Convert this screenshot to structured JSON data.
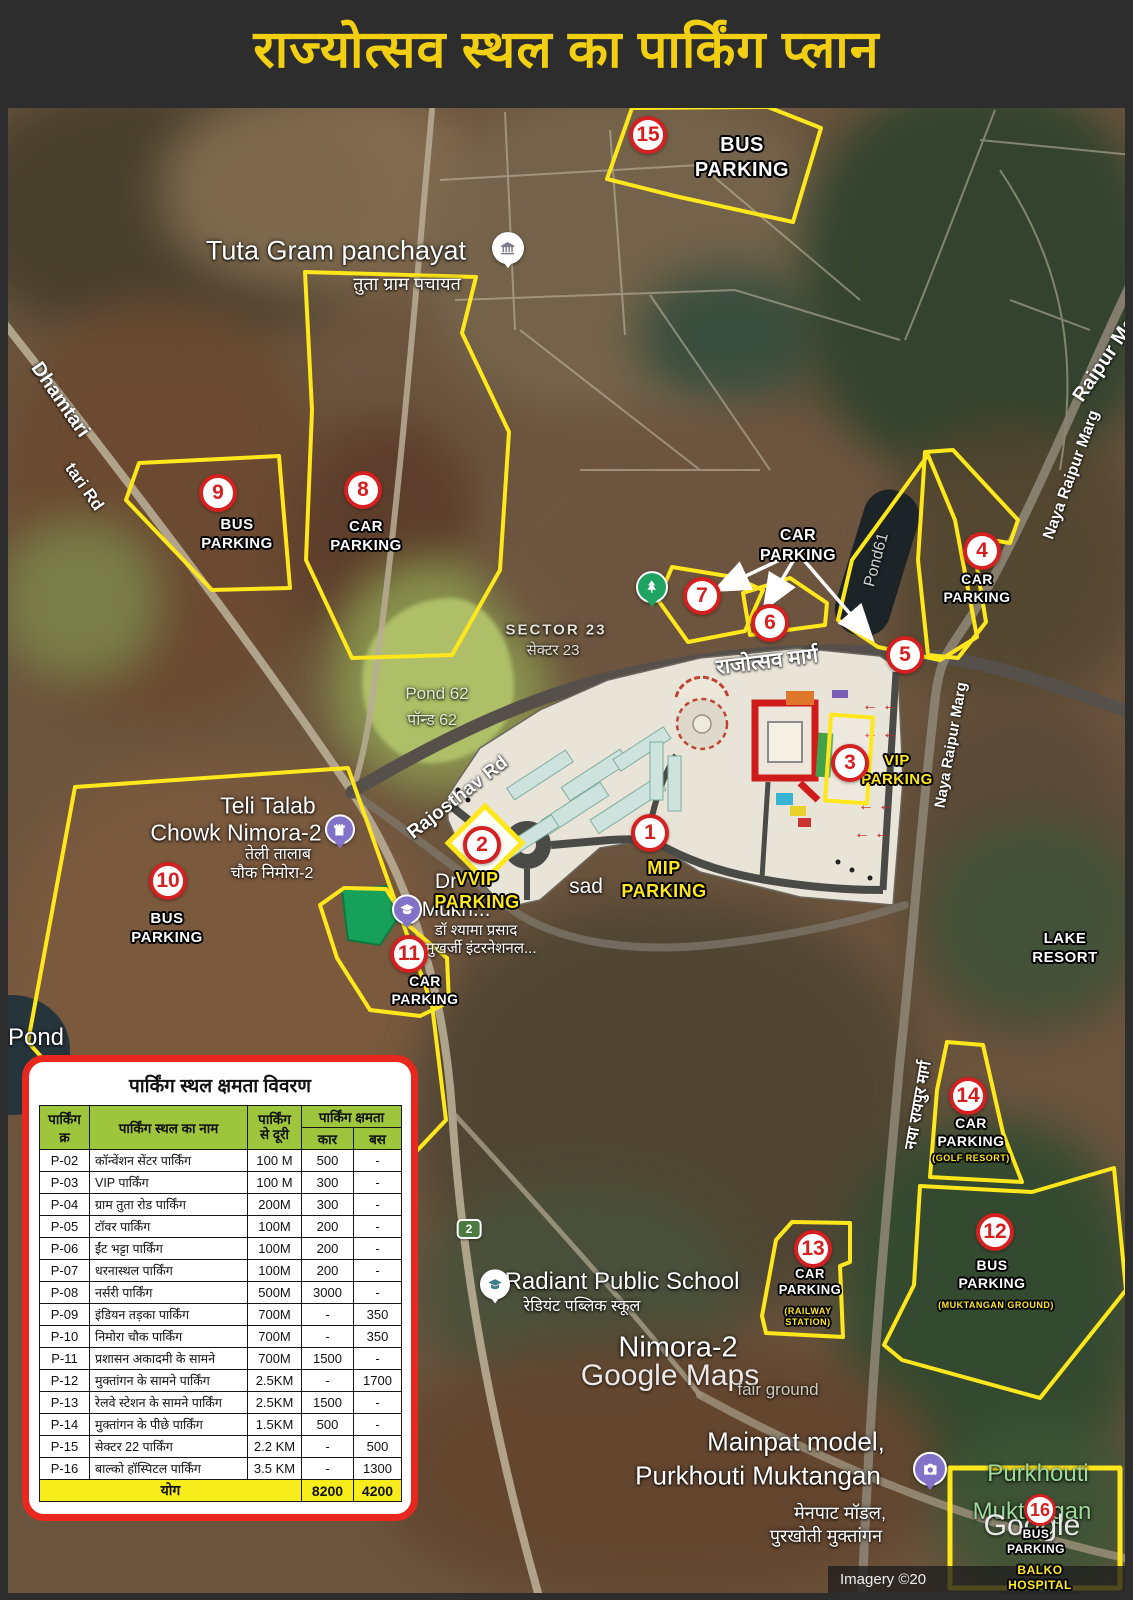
{
  "title": "राज्योत्सव स्थल का पार्किंग प्लान",
  "colors": {
    "accent_yellow": "#ffe71c",
    "marker_red": "#d42020",
    "title_yellow": "#f3cf11",
    "table_header_green": "#9dc63d",
    "table_total_yellow": "#f6ed1a",
    "table_border_red": "#e8281e"
  },
  "map": {
    "markers": [
      {
        "num": "1",
        "label": "MIP\nPARKING"
      },
      {
        "num": "2",
        "label": "VVIP\nPARKING"
      },
      {
        "num": "3",
        "label": "VIP\nPARKING"
      },
      {
        "num": "4",
        "label": "CAR\nPARKING"
      },
      {
        "num": "5"
      },
      {
        "num": "6"
      },
      {
        "num": "7"
      },
      {
        "num": "8",
        "label": "CAR\nPARKING"
      },
      {
        "num": "9",
        "label": "BUS\nPARKING"
      },
      {
        "num": "10",
        "label": "BUS\nPARKING"
      },
      {
        "num": "11",
        "label": "CAR\nPARKING"
      },
      {
        "num": "12",
        "label": "BUS\nPARKING",
        "sub": "(MUKTANGAN GROUND)"
      },
      {
        "num": "13",
        "label": "CAR\nPARKING",
        "sub": "(RAILWAY\nSTATION)"
      },
      {
        "num": "14",
        "label": "CAR\nPARKING",
        "sub": "(GOLF RESORT)"
      },
      {
        "num": "15",
        "label": "BUS\nPARKING"
      },
      {
        "num": "16",
        "label": "BUS\nPARKING",
        "sub": "BALKO HOSPITAL"
      }
    ],
    "pointer_label": "CAR\nPARKING",
    "places": {
      "tuta_en": "Tuta Gram panchayat",
      "tuta_hi": "तुता ग्राम पचायत",
      "sector23_en": "SECTOR 23",
      "sector23_hi": "सेक्टर 23",
      "pond62_en": "Pond 62",
      "pond62_hi": "पॉन्ड 62",
      "pond61": "Pond61",
      "pond_left": "Pond",
      "teli_en1": "Teli Talab",
      "teli_en2": "Chowk Nimora-2",
      "teli_hi1": "तेली तालाब",
      "teli_hi2": "चौक निमोरा-2",
      "dr_en1": "Dr",
      "dr_en2": "sad",
      "dr_en3": "Mukh...",
      "dr_hi1": "डॉ श्यामा प्रसाद",
      "dr_hi2": "मुखर्जी इंटरनेशनल...",
      "lake_resort": "LAKE RESORT",
      "radiant_en": "Radiant Public School",
      "radiant_hi": "रेडियंट पब्लिक स्कूल",
      "nimora": "Nimora-2",
      "fair_ground": "fair ground",
      "mainpat_en1": "Mainpat model,",
      "mainpat_en2": "Purkhouti Muktangan",
      "mainpat_hi1": "मेनपाट मॉडल,",
      "mainpat_hi2": "पुरखोती मुक्तांगन",
      "purkhouti_green1": "Purkhouti",
      "purkhouti_green2": "Muktangan"
    },
    "roads": {
      "dhamtari1": "Dhamtari",
      "dhamtari2": "tari Rd",
      "rajosthav_rd": "Rajosthav Rd",
      "rajotsav_hi": "राजोत्सव मार्ग",
      "naya1": "Naya Raipur Marg",
      "naya2": "Raipur Ma",
      "naya3": "Naya Raipur Marg",
      "naya_hi": "नया रायपुर मार्ग",
      "route_shield": "2"
    },
    "watermarks": {
      "google_maps": "Google Maps",
      "google": "Google",
      "imagery": "Imagery ©20"
    }
  },
  "table": {
    "title": "पार्किंग स्थल क्षमता विवरण",
    "headers": {
      "id": "पार्किंग क्र",
      "name": "पार्किंग स्थल का नाम",
      "dist": "पार्किंग\nसे दूरी",
      "capacity": "पार्किंग क्षमता",
      "car": "कार",
      "bus": "बस"
    },
    "rows": [
      {
        "id": "P-02",
        "name": "कॉन्वेंशन सेंटर पार्किंग",
        "dist": "100 M",
        "car": "500",
        "bus": "-"
      },
      {
        "id": "P-03",
        "name": "VIP पार्किंग",
        "dist": "100 M",
        "car": "300",
        "bus": "-"
      },
      {
        "id": "P-04",
        "name": "ग्राम तुता रोड पार्किंग",
        "dist": "200M",
        "car": "300",
        "bus": "-"
      },
      {
        "id": "P-05",
        "name": "टॉवर पार्किंग",
        "dist": "100M",
        "car": "200",
        "bus": "-"
      },
      {
        "id": "P-06",
        "name": "ईंट भट्टा पार्किंग",
        "dist": "100M",
        "car": "200",
        "bus": "-"
      },
      {
        "id": "P-07",
        "name": "धरनास्थल पार्किंग",
        "dist": "100M",
        "car": "200",
        "bus": "-"
      },
      {
        "id": "P-08",
        "name": "नर्सरी पार्किंग",
        "dist": "500M",
        "car": "3000",
        "bus": "-"
      },
      {
        "id": "P-09",
        "name": "इंडियन तड़का पार्किंग",
        "dist": "700M",
        "car": "-",
        "bus": "350"
      },
      {
        "id": "P-10",
        "name": "निमोरा चौक पार्किंग",
        "dist": "700M",
        "car": "-",
        "bus": "350"
      },
      {
        "id": "P-11",
        "name": "प्रशासन अकादमी के सामने",
        "dist": "700M",
        "car": "1500",
        "bus": "-"
      },
      {
        "id": "P-12",
        "name": "मुक्तांगन के सामने पार्किंग",
        "dist": "2.5KM",
        "car": "-",
        "bus": "1700"
      },
      {
        "id": "P-13",
        "name": "रेलवे स्टेशन के सामने पार्किंग",
        "dist": "2.5KM",
        "car": "1500",
        "bus": "-"
      },
      {
        "id": "P-14",
        "name": "मुक्तांगन के पीछे पार्किंग",
        "dist": "1.5KM",
        "car": "500",
        "bus": "-"
      },
      {
        "id": "P-15",
        "name": "सेक्टर 22 पार्किंग",
        "dist": "2.2 KM",
        "car": "-",
        "bus": "500"
      },
      {
        "id": "P-16",
        "name": "बाल्को हॉस्पिटल पार्किंग",
        "dist": "3.5 KM",
        "car": "-",
        "bus": "1300"
      }
    ],
    "total": {
      "label": "योग",
      "car": "8200",
      "bus": "4200"
    }
  }
}
